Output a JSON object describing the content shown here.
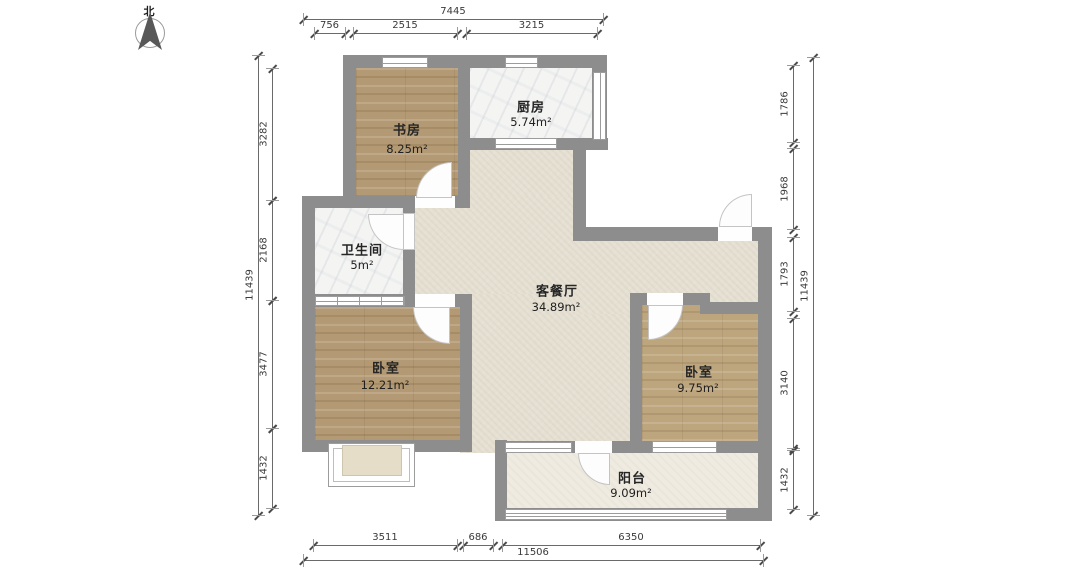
{
  "title": "户型图",
  "compass": {
    "north_label": "北"
  },
  "rooms": {
    "study": {
      "name": "书房",
      "area": "8.25m²"
    },
    "kitchen": {
      "name": "厨房",
      "area": "5.74m²"
    },
    "bathroom": {
      "name": "卫生间",
      "area": "5m²"
    },
    "living": {
      "name": "客餐厅",
      "area": "34.89m²"
    },
    "bedroom_left": {
      "name": "卧室",
      "area": "12.21m²"
    },
    "bedroom_right": {
      "name": "卧室",
      "area": "9.75m²"
    },
    "balcony": {
      "name": "阳台",
      "area": "9.09m²"
    }
  },
  "dimensions": {
    "top": {
      "total": "7445",
      "segments": [
        "756",
        "2515",
        "3215"
      ]
    },
    "left": {
      "total": "11439",
      "segments": [
        "3282",
        "2168",
        "3477",
        "1432"
      ]
    },
    "right": {
      "total": "11439",
      "segments": [
        "1786",
        "1968",
        "1793",
        "3140",
        "1432"
      ]
    },
    "bottom": {
      "total": "11506",
      "segments": [
        "3511",
        "686",
        "6350"
      ]
    }
  },
  "colors": {
    "wall": "#8d8d8d",
    "wood_floor": "#b49a74",
    "wood_floor_light": "#bda67e",
    "tile_floor": "#f4f4f3",
    "living_floor": "#e6e0d3",
    "balcony_floor": "#efebe1",
    "bay_window_fill": "#e6ddc8",
    "dimension_text": "#3a3a3a",
    "label_text": "#262626"
  }
}
